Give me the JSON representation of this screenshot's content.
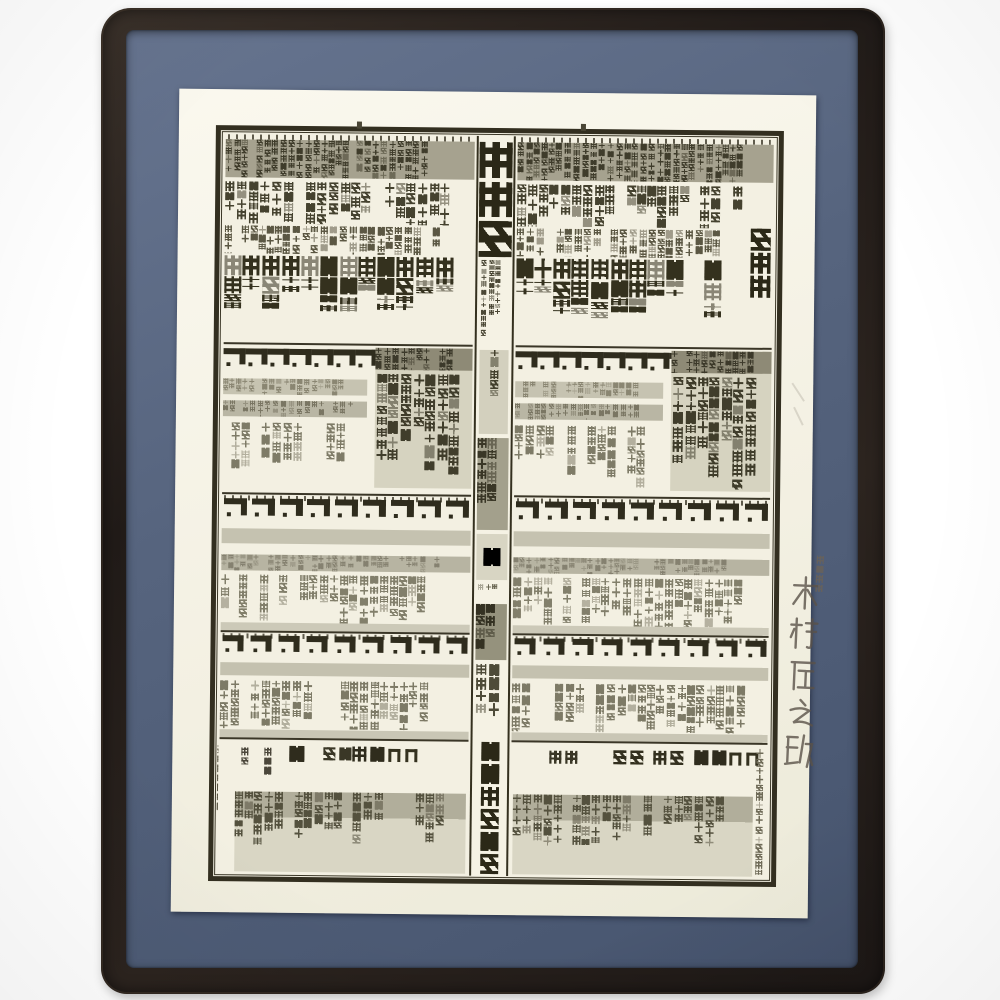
{
  "scene": {
    "background_color": "#ffffff",
    "frame_color": "#2a231e",
    "mat_color": "#57657f",
    "paper_color": "#f6f3e8",
    "ink_color": "#33301f"
  },
  "print": {
    "center_title": "蒙御免",
    "association": "日本相撲協会",
    "east_top_name": "白鵬",
    "ditto_mark": "同",
    "left_labels": [
      "主任",
      "年寄",
      "客",
      "呼出し",
      "床山",
      "千穐萬歳大々叶"
    ],
    "right_labels": [
      "理事",
      "監事",
      "監査",
      "委員"
    ]
  },
  "handwriting": {
    "generation": "五十七代",
    "name": "木村庄之助"
  }
}
